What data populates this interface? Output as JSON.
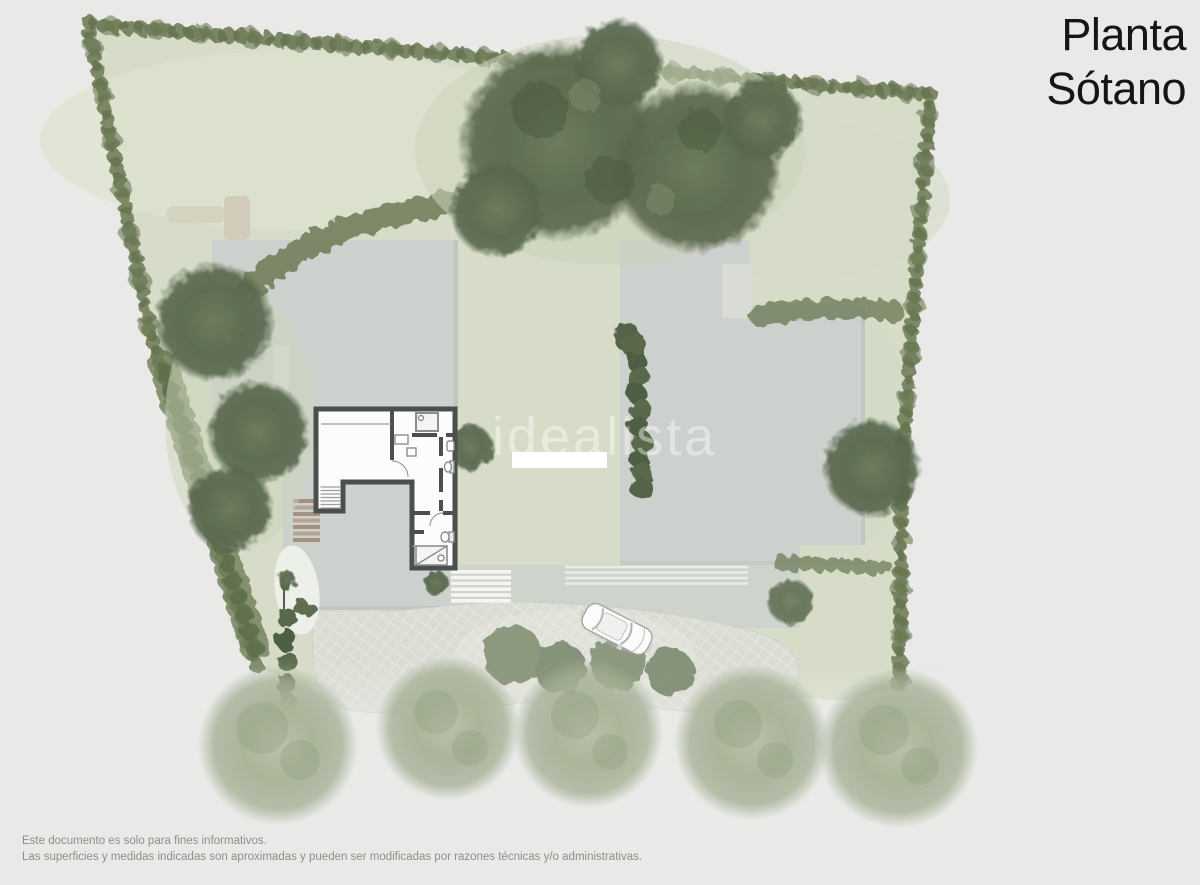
{
  "header": {
    "title_line1": "Planta",
    "title_line2": "Sótano",
    "title_full": "Planta Sótano"
  },
  "watermark": {
    "text": "idealista"
  },
  "footer": {
    "line1": "Este documento es solo para fines informativos.",
    "line2": "Las superficies y medidas indicadas son aproximadas y pueden ser modificadas por razones técnicas y/o administrativas."
  },
  "plan": {
    "kind": "architectural-site-plan",
    "floor_label": "Planta Sótano",
    "features": [
      "perimeter-hedge",
      "lawn",
      "garden-trees",
      "building-roofs",
      "basement-floor-plan",
      "interior-staircase",
      "exterior-steps",
      "terrace",
      "paved-driveway",
      "parked-car",
      "pool-bench",
      "bottom-tree-row"
    ]
  },
  "colors": {
    "background": "#e9eae7",
    "lawn": "#d6dcc7",
    "hedge_green": "#76835f",
    "dark_tree": "#5e6d51",
    "pale_tree": "#aab59a",
    "roof_gray": "#cdd1cd",
    "wall_dark": "#4b4f4d",
    "paving": "#dbddd4",
    "path_beige": "#cfc9b6",
    "steps_brown": "#a5917f",
    "car_body": "#fafbfa",
    "title_text": "#151515",
    "footer_text": "#8e8e88"
  }
}
